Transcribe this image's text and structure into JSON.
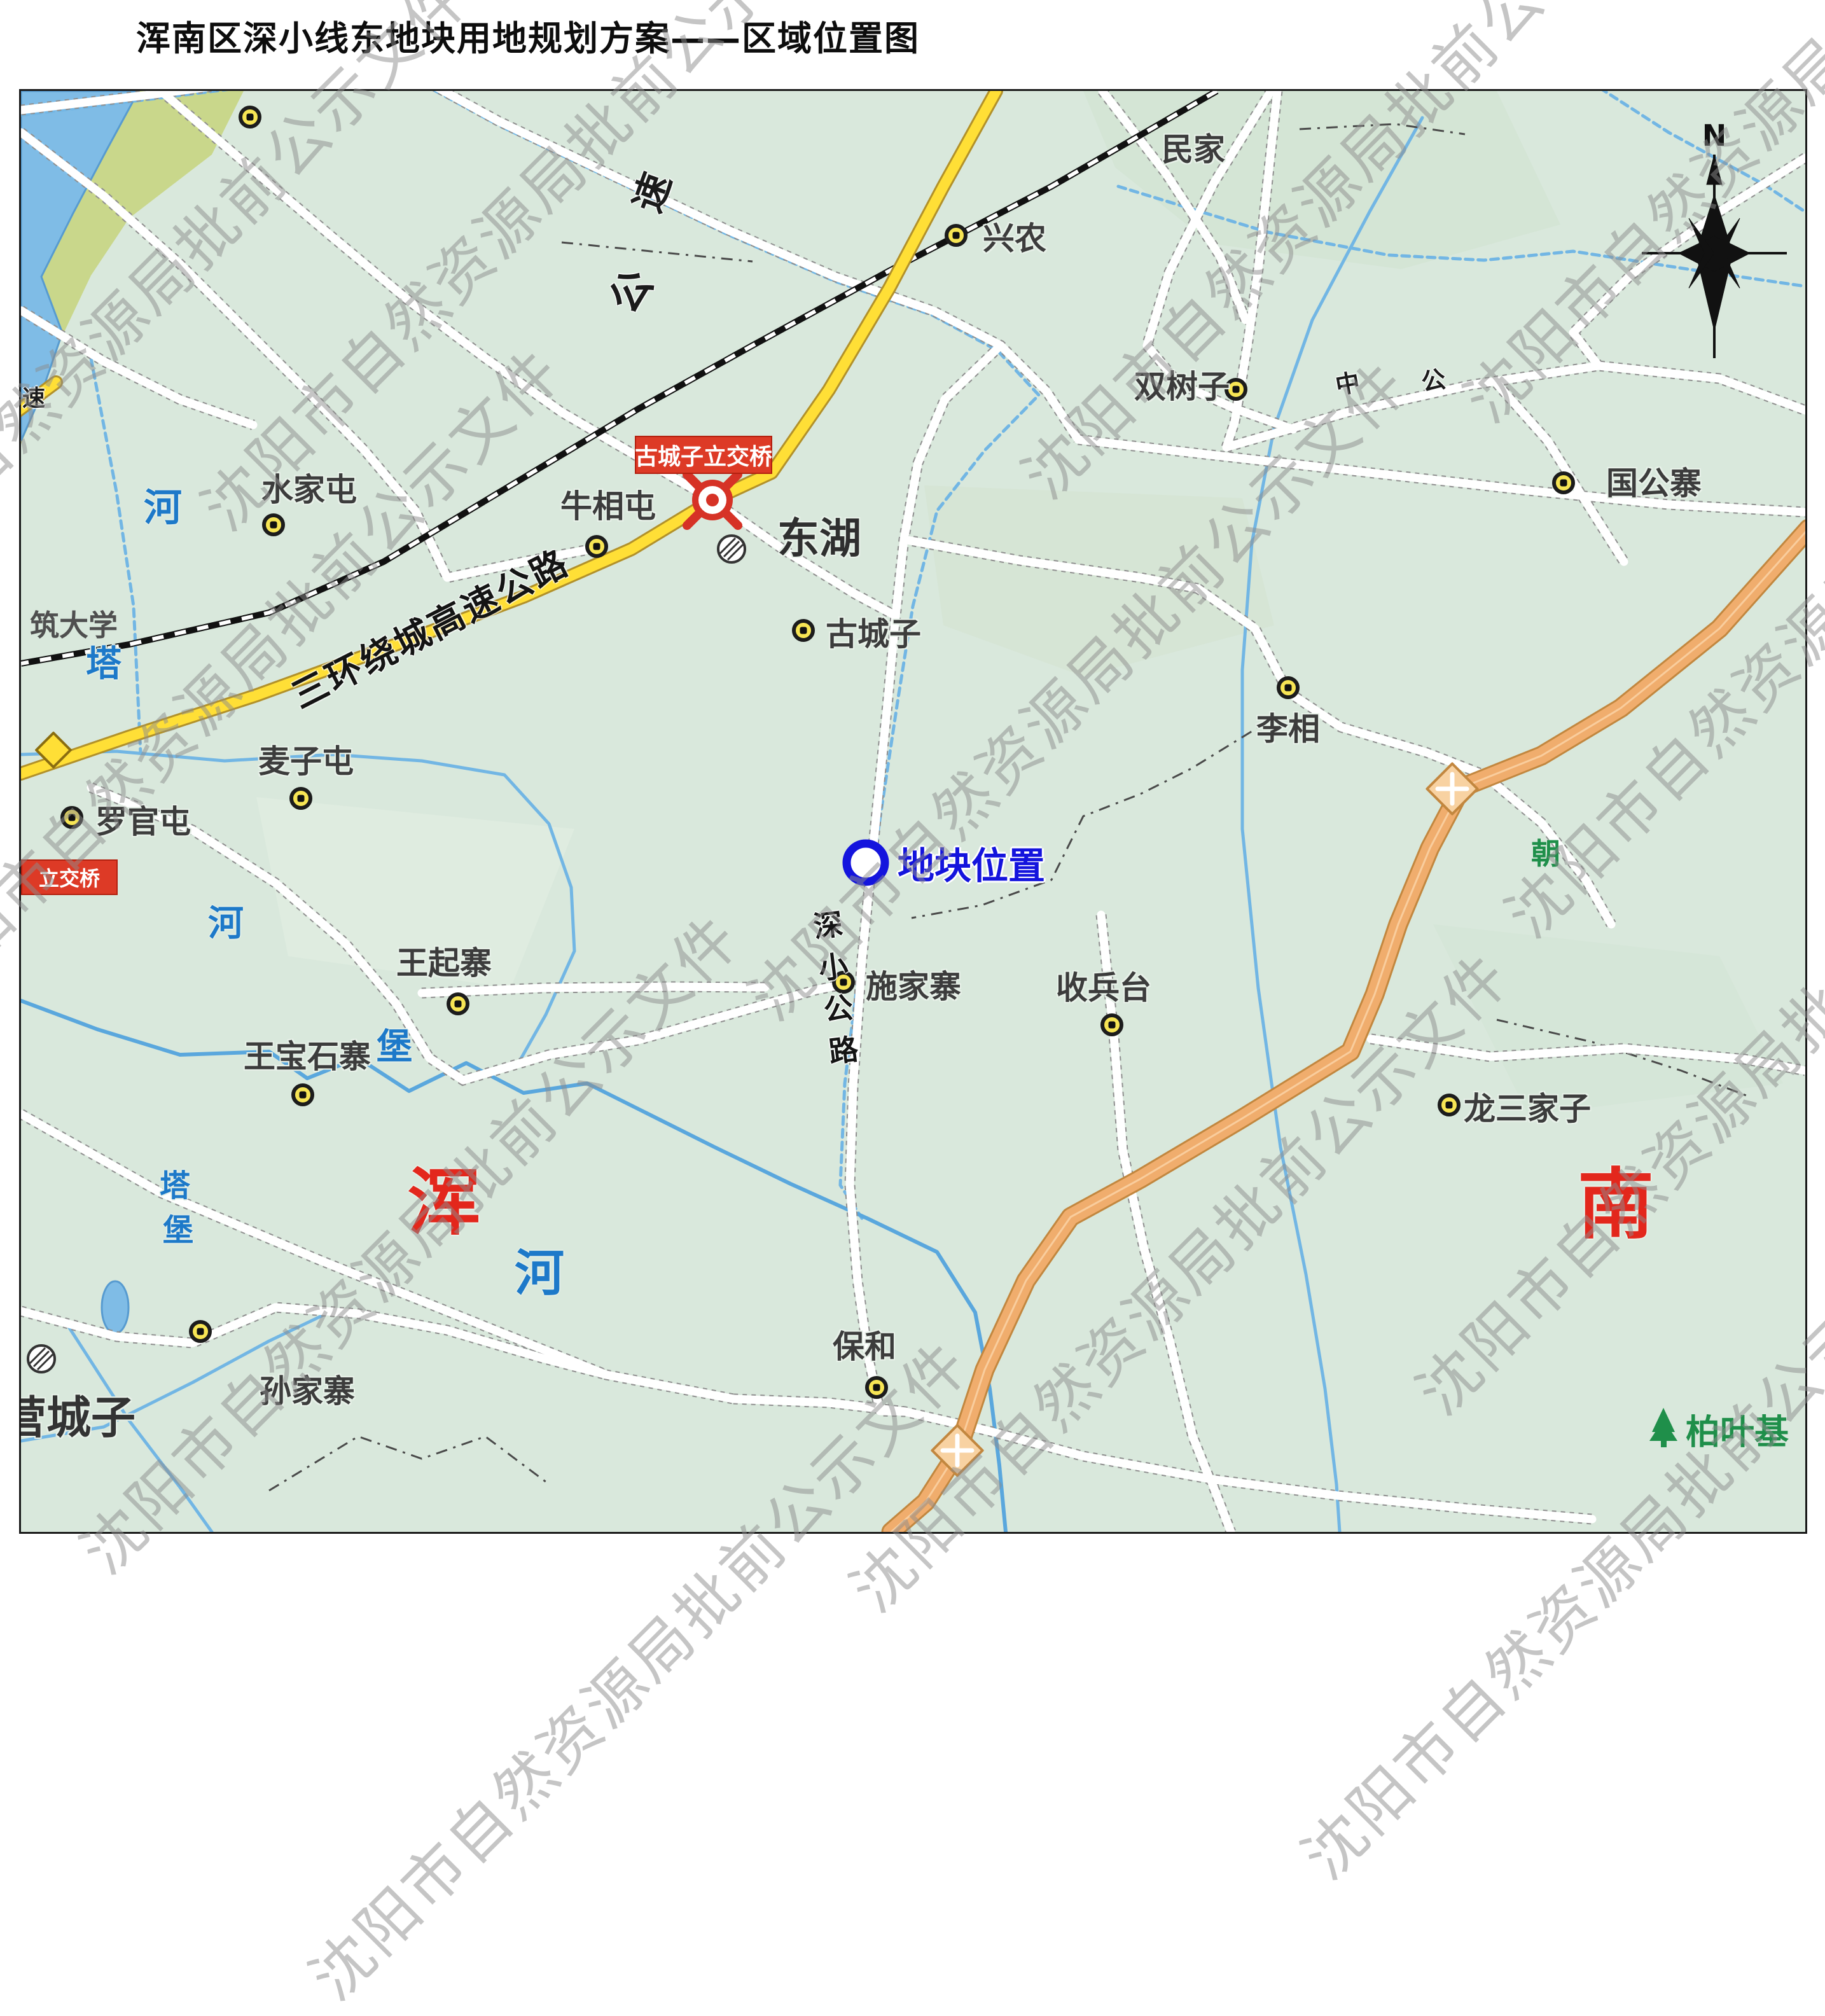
{
  "title": "浑南区深小线东地块用地规划方案——区域位置图",
  "watermark": "沈阳市自然资源局批前公示文件",
  "compass": {
    "north": "N"
  },
  "plot": {
    "label": "地块位置"
  },
  "roads": {
    "ring_expressway": "三环绕城高速公路",
    "ring_char_su": "速",
    "ring_char_gong": "公",
    "edge_stub_char": "速",
    "shenxiao": [
      "深",
      "小",
      "公",
      "路"
    ],
    "char_zhong": "中",
    "char_gong": "公"
  },
  "interchanges": {
    "guchengzi": "古城子立交桥",
    "left_partial": "立交桥"
  },
  "villages": [
    {
      "name": "民家"
    },
    {
      "name": "兴农"
    },
    {
      "name": "双树子"
    },
    {
      "name": "国公寨"
    },
    {
      "name": "水家屯"
    },
    {
      "name": "牛相屯"
    },
    {
      "name": "古城子"
    },
    {
      "name": "李相"
    },
    {
      "name": "麦子屯"
    },
    {
      "name": "罗官屯"
    },
    {
      "name": "王起寨"
    },
    {
      "name": "王宝石寨"
    },
    {
      "name": "施家寨"
    },
    {
      "name": "收兵台"
    },
    {
      "name": "龙三家子"
    },
    {
      "name": "保和"
    },
    {
      "name": "孙家寨"
    }
  ],
  "areas": {
    "donghu": "东湖",
    "yingchengzi": "营城子",
    "hun": "浑",
    "nan": "南"
  },
  "rivers": [
    {
      "ch": "河"
    },
    {
      "ch": "塔"
    },
    {
      "ch": "河"
    },
    {
      "ch": "堡"
    },
    {
      "ch": "塔"
    },
    {
      "ch": "堡"
    },
    {
      "ch": "河"
    }
  ],
  "green": {
    "baiyeji": "柏叶基",
    "chao": "朝"
  },
  "misc": {
    "university": "筑大学"
  }
}
